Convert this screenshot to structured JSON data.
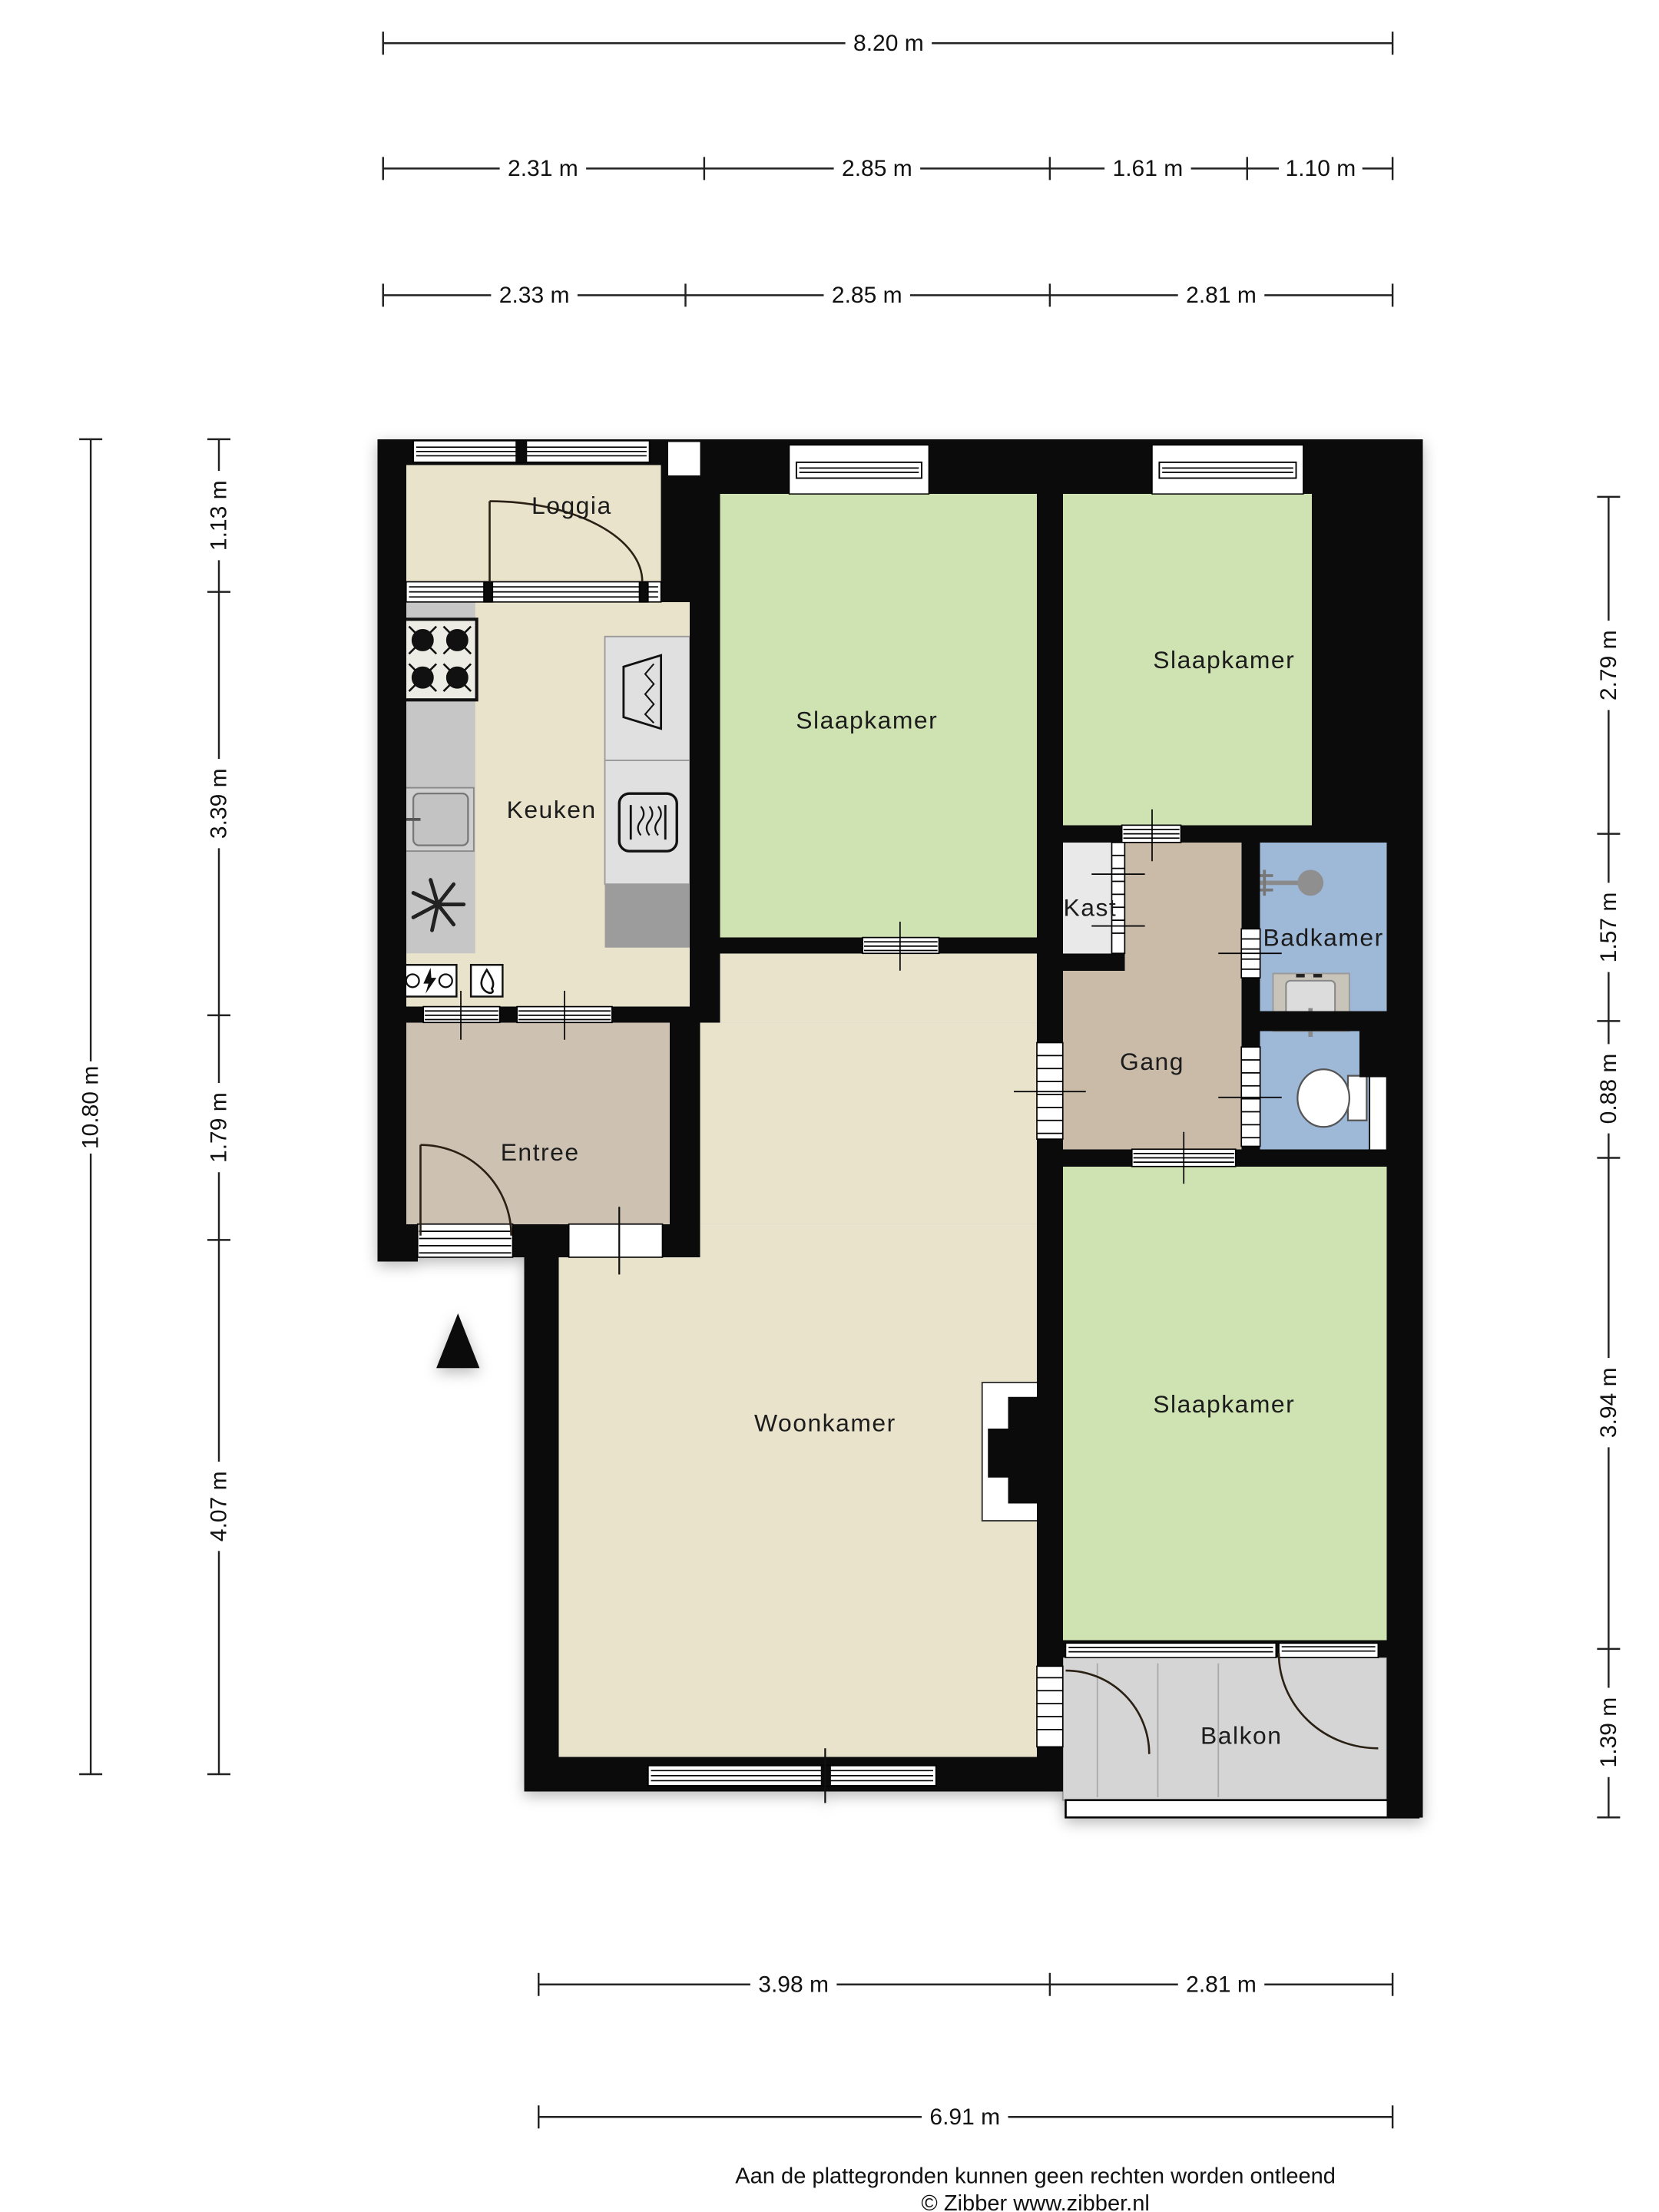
{
  "colors": {
    "wall": "#0b0b0b",
    "bedroom": "#cfe3b2",
    "living": "#eae3cc",
    "hall": "#c9bba8",
    "entry": "#cdc1b1",
    "bath": "#9eb8d8",
    "closet": "#e9e9e9",
    "balcony": "#d5d5d5",
    "counter": "#c6c6c6",
    "cabinet": "#e0e0e0",
    "cabinet_dark": "#9c9c9c"
  },
  "rooms": {
    "loggia": "Loggia",
    "keuken": "Keuken",
    "slaapkamer_top": "Slaapkamer",
    "slaapkamer_right": "Slaapkamer",
    "slaapkamer_bottom": "Slaapkamer",
    "kast": "Kast",
    "gang": "Gang",
    "badkamer": "Badkamer",
    "entree": "Entree",
    "woonkamer": "Woonkamer",
    "balkon": "Balkon"
  },
  "dimensions": {
    "top_total": "8.20 m",
    "top_row2": [
      "2.31 m",
      "2.85 m",
      "1.61 m",
      "1.10 m"
    ],
    "top_row3": [
      "2.33 m",
      "2.85 m",
      "2.81 m"
    ],
    "left_total": "10.80 m",
    "left_inner": [
      "1.13 m",
      "3.39 m",
      "1.79 m",
      "4.07 m"
    ],
    "right": [
      "2.79 m",
      "1.57 m",
      "0.88 m",
      "3.94 m",
      "1.39 m"
    ],
    "bottom_row": [
      "3.98 m",
      "2.81 m"
    ],
    "bottom_total": "6.91 m"
  },
  "footer": {
    "disclaimer": "Aan de plattegronden kunnen geen rechten worden ontleend",
    "copyright": "© Zibber www.zibber.nl"
  }
}
